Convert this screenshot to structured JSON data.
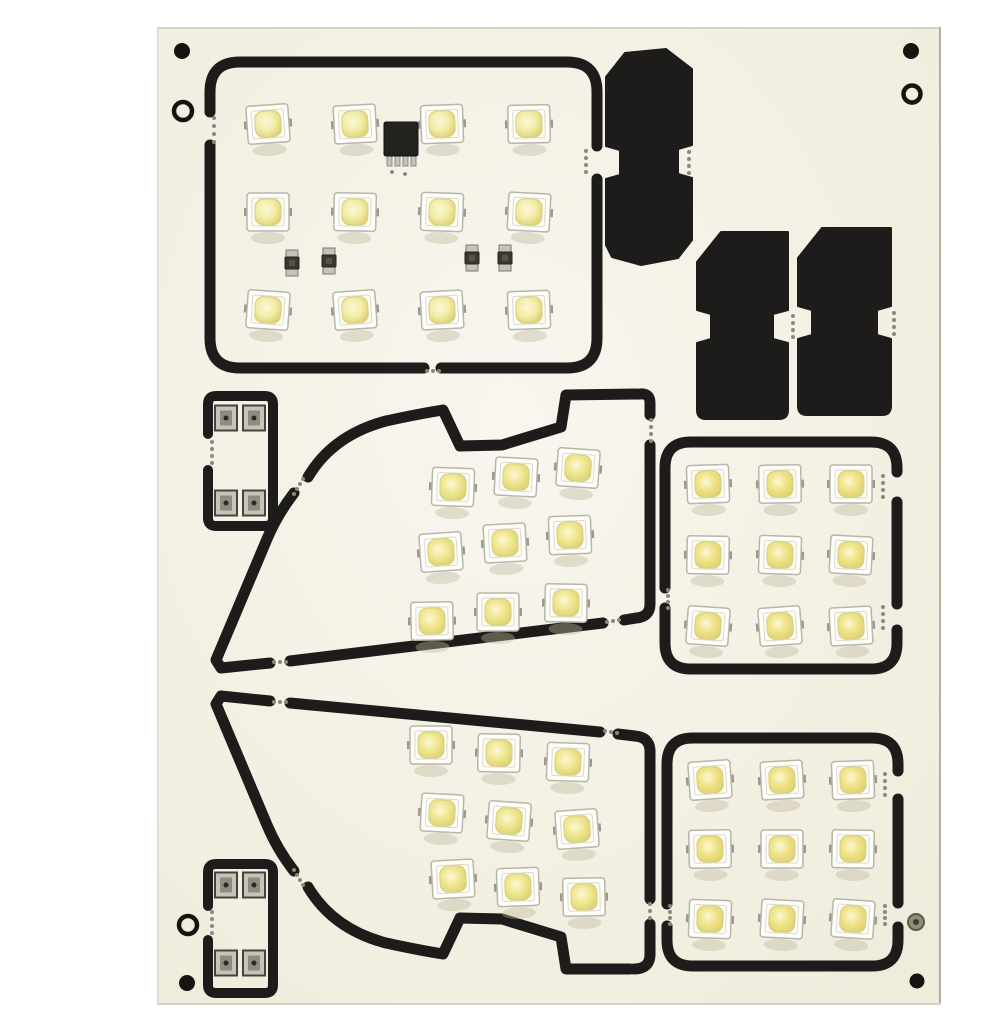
{
  "meta": {
    "label": "Photo of an off-white PCB panel containing white SMD LED car interior light modules with black routed outlines, festoon adapter blanks and connector boards",
    "total_led_count": 48
  },
  "palette": {
    "photo_bg": "#ffffff",
    "board_fill_center": "#f8f6ef",
    "board_fill_edge": "#f0ecdc",
    "edge_top": "#d6d2c4",
    "edge_left": "#dcd8cb",
    "edge_right": "#b3b0a2",
    "edge_bottom": "#d6d2c4",
    "outline": "#1d1c1a",
    "tab_dot": "#8b897d",
    "led_body": "#fdfdf9",
    "led_border": "#b8b5a9",
    "led_pad": "#9b998d",
    "led_shadow": "rgba(190,185,158,0.40)",
    "phosphor_hi": "#fbf8d6",
    "phosphor_edge": "#ddd277",
    "metal": "#c6c4ba",
    "metal_dark": "#45433c",
    "metal_core": "#2a2925",
    "ic_body": "#23221f"
  },
  "board": {
    "x": 118,
    "y": 11,
    "w": 783,
    "h": 978
  },
  "holes": [
    {
      "type": "dot",
      "x": 142,
      "y": 35,
      "r": 8
    },
    {
      "type": "ring",
      "x": 143,
      "y": 95,
      "r": 9
    },
    {
      "type": "dot",
      "x": 871,
      "y": 35,
      "r": 8
    },
    {
      "type": "ring",
      "x": 872,
      "y": 78,
      "r": 8.5
    },
    {
      "type": "ring",
      "x": 148,
      "y": 909,
      "r": 9
    },
    {
      "type": "dot",
      "x": 147,
      "y": 967,
      "r": 8
    },
    {
      "type": "rivet",
      "x": 876,
      "y": 906,
      "r": 8
    },
    {
      "type": "dot",
      "x": 877,
      "y": 965,
      "r": 7.5
    }
  ],
  "modules": [
    {
      "id": "main-light-panel",
      "kind": "led-panel",
      "led_count": 12,
      "phosphor": "#f2eda8",
      "stroke_paths": [
        "M 170,96 L 170,76 Q 170,46 200,46 L 527,46 Q 557,46 557,76 L 557,130",
        "M 557,163 L 557,322 Q 557,352 527,352 L 401,352",
        "M 384,352 L 200,352 Q 170,352 170,322 L 170,129"
      ],
      "leds": [
        [
          228,
          108
        ],
        [
          315,
          108
        ],
        [
          402,
          108
        ],
        [
          489,
          108
        ],
        [
          228,
          196
        ],
        [
          315,
          196
        ],
        [
          402,
          196
        ],
        [
          489,
          196
        ],
        [
          228,
          294
        ],
        [
          315,
          294
        ],
        [
          402,
          294
        ],
        [
          489,
          294
        ]
      ],
      "ic": {
        "x": 344,
        "y": 106,
        "w": 34,
        "h": 34,
        "legs": 4
      },
      "transistors": [
        [
          252,
          247
        ],
        [
          289,
          245
        ],
        [
          432,
          242
        ],
        [
          465,
          242
        ]
      ]
    },
    {
      "id": "festoon-adapter-large",
      "kind": "black-blank",
      "led_count": 0,
      "fill_paths": [
        "M 566,61 L 585,37 L 626,33 L 652,53 L 652,129 L 638,133 L 638,158 L 652,162 L 652,224 L 638,242 L 601,249 L 572,241 L 566,229 L 566,163 L 580,159 L 580,134 L 566,130 Z"
      ]
    },
    {
      "id": "festoon-adapter-small-1",
      "kind": "black-blank",
      "led_count": 0,
      "fill_paths": [
        "M 657,246 L 681,216 L 748,216 L 748,294 L 733,298 L 733,323 L 748,327 L 748,394 Q 748,403 739,403 L 666,403 Q 657,403 657,394 L 657,327 L 671,323 L 671,298 L 657,294 Z"
      ]
    },
    {
      "id": "festoon-adapter-small-2",
      "kind": "black-blank",
      "led_count": 0,
      "fill_paths": [
        "M 758,242 L 782,212 L 851,212 L 851,290 L 837,294 L 837,319 L 851,323 L 851,390 Q 851,399 842,399 L 767,399 Q 758,399 758,390 L 758,323 L 772,319 L 772,294 L 758,290 Z"
      ]
    },
    {
      "id": "connector-board-top",
      "kind": "connector",
      "led_count": 0,
      "stroke_width": 10,
      "stroke_paths": [
        "M 168,418 L 168,388 Q 168,380 176,380 L 225,380 Q 233,380 233,388 L 233,502 Q 233,510 225,510 L 176,510 Q 168,510 168,502 L 168,454"
      ],
      "pads": [
        [
          186,
          402
        ],
        [
          214,
          402
        ],
        [
          186,
          487
        ],
        [
          214,
          487
        ]
      ]
    },
    {
      "id": "connector-board-bottom",
      "kind": "connector",
      "led_count": 0,
      "stroke_width": 10,
      "stroke_paths": [
        "M 168,890 L 168,856 Q 168,848 176,848 L 225,848 Q 233,848 233,856 L 233,969 Q 233,977 225,977 L 176,977 Q 168,977 168,969 L 168,924"
      ],
      "pads": [
        [
          186,
          869
        ],
        [
          214,
          869
        ],
        [
          186,
          947
        ],
        [
          214,
          947
        ]
      ]
    },
    {
      "id": "wedge-panel-upper",
      "kind": "led-panel",
      "led_count": 9,
      "phosphor": "#efe68d",
      "stroke_paths": [
        "M 268,461 Q 293,419 346,405 Q 378,398 403,394 L 420,430 L 462,429 L 521,411 L 526,379 L 600,378 Q 610,377 610,387 L 610,399",
        "M 254,477 Q 237,499 227,523 L 176,644 L 181,652 L 230,647",
        "M 250,645 L 563,607",
        "M 584,604 L 596,602 Q 610,601 610,588 L 610,429"
      ],
      "leds": [
        [
          413,
          471
        ],
        [
          476,
          461
        ],
        [
          538,
          452
        ],
        [
          401,
          536
        ],
        [
          465,
          527
        ],
        [
          530,
          519
        ],
        [
          392,
          605
        ],
        [
          458,
          596
        ],
        [
          526,
          587
        ]
      ]
    },
    {
      "id": "wedge-panel-lower",
      "kind": "led-panel",
      "led_count": 9,
      "phosphor": "#efe68d",
      "stroke_paths": [
        "M 268,871 Q 293,913 346,927 Q 378,934 403,938 L 420,902 L 462,903 L 521,921 L 526,953 L 590,953",
        "M 254,855 Q 237,833 227,809 L 176,688 L 181,680 L 230,685",
        "M 250,687 L 560,716",
        "M 578,718 L 595,720 Q 609,721 610,734 L 610,883",
        "M 610,908 L 610,938 Q 610,953 594,953"
      ],
      "leds": [
        [
          391,
          729
        ],
        [
          459,
          737
        ],
        [
          528,
          746
        ],
        [
          402,
          797
        ],
        [
          469,
          805
        ],
        [
          537,
          813
        ],
        [
          413,
          863
        ],
        [
          478,
          871
        ],
        [
          544,
          881
        ]
      ]
    },
    {
      "id": "square-panel-middle",
      "kind": "led-panel",
      "led_count": 9,
      "phosphor": "#efe283",
      "stroke_paths": [
        "M 625,572 L 625,452 Q 625,426 651,426 L 831,426 Q 857,426 857,452 L 857,456",
        "M 857,486 L 857,588",
        "M 857,614 L 857,627 Q 857,653 831,653 L 651,653 Q 625,653 625,627 L 625,592"
      ],
      "leds": [
        [
          668,
          468
        ],
        [
          740,
          468
        ],
        [
          811,
          468
        ],
        [
          668,
          539
        ],
        [
          740,
          539
        ],
        [
          811,
          539
        ],
        [
          668,
          610
        ],
        [
          740,
          610
        ],
        [
          811,
          610
        ]
      ]
    },
    {
      "id": "square-panel-bottom",
      "kind": "led-panel",
      "led_count": 9,
      "phosphor": "#efe283",
      "stroke_paths": [
        "M 627,888 L 627,748 Q 627,722 653,722 L 832,722 Q 858,722 858,748 L 858,755",
        "M 858,783 L 858,887",
        "M 858,911 L 858,924 Q 858,950 832,950 L 653,950 Q 627,950 627,924 L 627,910"
      ],
      "leds": [
        [
          670,
          764
        ],
        [
          742,
          764
        ],
        [
          813,
          764
        ],
        [
          670,
          833
        ],
        [
          742,
          833
        ],
        [
          813,
          833
        ],
        [
          670,
          903
        ],
        [
          742,
          903
        ],
        [
          813,
          903
        ]
      ]
    }
  ],
  "tabs": [
    {
      "x": 174,
      "y": 102,
      "dx": 0,
      "dy": 8,
      "n": 4
    },
    {
      "x": 387,
      "y": 355,
      "dx": 6,
      "dy": 0,
      "n": 3
    },
    {
      "x": 546,
      "y": 135,
      "dx": 0,
      "dy": 7,
      "n": 4
    },
    {
      "x": 649,
      "y": 136,
      "dx": 0,
      "dy": 7,
      "n": 4
    },
    {
      "x": 753,
      "y": 300,
      "dx": 0,
      "dy": 7,
      "n": 4
    },
    {
      "x": 854,
      "y": 297,
      "dx": 0,
      "dy": 7,
      "n": 4
    },
    {
      "x": 172,
      "y": 426,
      "dx": 0,
      "dy": 7,
      "n": 4
    },
    {
      "x": 172,
      "y": 896,
      "dx": 0,
      "dy": 7,
      "n": 4
    },
    {
      "x": 263,
      "y": 463,
      "dx": -3,
      "dy": 5,
      "n": 4
    },
    {
      "x": 234,
      "y": 646,
      "dx": 6,
      "dy": 0,
      "n": 3
    },
    {
      "x": 567,
      "y": 606,
      "dx": 6,
      "dy": -1,
      "n": 3
    },
    {
      "x": 611,
      "y": 404,
      "dx": 0,
      "dy": 7,
      "n": 4
    },
    {
      "x": 263,
      "y": 869,
      "dx": -3,
      "dy": -5,
      "n": 4
    },
    {
      "x": 234,
      "y": 686,
      "dx": 6,
      "dy": 0,
      "n": 3
    },
    {
      "x": 565,
      "y": 715,
      "dx": 6,
      "dy": 1,
      "n": 3
    },
    {
      "x": 610,
      "y": 888,
      "dx": 0,
      "dy": 7,
      "n": 3
    },
    {
      "x": 628,
      "y": 574,
      "dx": 0,
      "dy": 6,
      "n": 4
    },
    {
      "x": 843,
      "y": 460,
      "dx": 0,
      "dy": 7,
      "n": 4
    },
    {
      "x": 843,
      "y": 591,
      "dx": 0,
      "dy": 7,
      "n": 4
    },
    {
      "x": 630,
      "y": 890,
      "dx": 0,
      "dy": 6,
      "n": 4
    },
    {
      "x": 845,
      "y": 758,
      "dx": 0,
      "dy": 7,
      "n": 4
    },
    {
      "x": 845,
      "y": 890,
      "dx": 0,
      "dy": 6,
      "n": 4
    }
  ]
}
